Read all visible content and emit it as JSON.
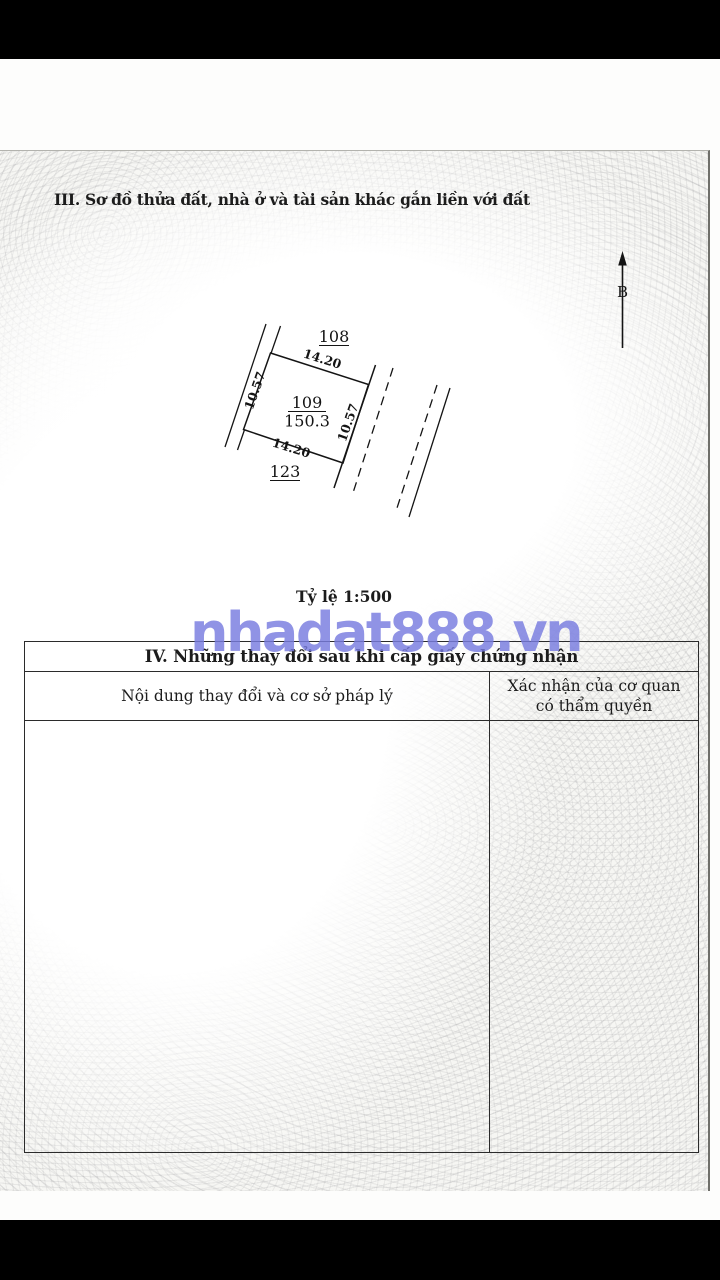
{
  "section3": {
    "title": "III. Sơ đồ thửa đất, nhà ở và tài sản khác gắn liền với đất"
  },
  "diagram": {
    "north_label": "B",
    "neighbor_top": "108",
    "neighbor_bottom": "123",
    "parcel_number": "109",
    "parcel_area": "150.3",
    "dim_top": "14.20",
    "dim_bottom": "14.20",
    "dim_left": "10.57",
    "dim_right": "10.57",
    "scale_label": "Tỷ lệ 1:500"
  },
  "section4": {
    "title": "IV. Những thay đổi sau khi cấp giấy chứng nhận",
    "col1_header": "Nội dung thay đổi và cơ sở pháp lý",
    "col2_header_line1": "Xác nhận của cơ quan",
    "col2_header_line2": "có thẩm quyền"
  },
  "watermark": {
    "text": "nhadat888.vn",
    "color": "#787ce0"
  },
  "colors": {
    "ink": "#1c1c1c",
    "table_border": "#2b2b2b",
    "paper": "#f6f6f3",
    "photo_frame": "#000000"
  }
}
